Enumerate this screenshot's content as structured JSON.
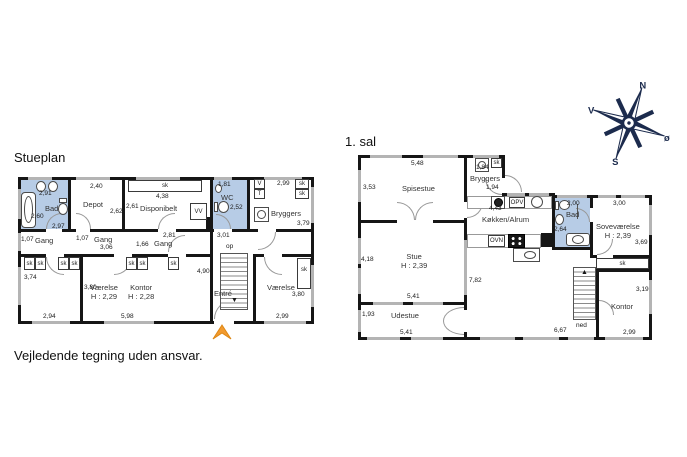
{
  "titles": {
    "stueplan": "Stueplan",
    "first_floor": "1. sal",
    "disclaimer": "Vejledende tegning uden ansvar."
  },
  "labels": {
    "sk": "sk",
    "op": "op",
    "ned": "ned",
    "vv": "VV",
    "v": "V",
    "t": "T",
    "opv": "OPV",
    "ovn": "OVN"
  },
  "compass": {
    "north": "N",
    "south": "S",
    "west": "V",
    "east": "ø"
  },
  "colors": {
    "wall": "#161616",
    "window_gray": "#b4b4b4",
    "wet_room_blue": "#b7cce6",
    "entrance_arrow_orange": "#f29a2e",
    "compass_navy": "#1c2b4d"
  },
  "stueplan": {
    "bad": {
      "name": "Bad",
      "dim_sinks": "2,91",
      "dim_left": "2,60",
      "dim_bottom": "2,97"
    },
    "depot": {
      "name": "Depot",
      "dim_top": "2,40",
      "dim_right": "2,62"
    },
    "disponibelt": {
      "name": "Disponibelt",
      "closet_dim": "4,38",
      "dim_left": "2,61"
    },
    "wc": {
      "name": "WC",
      "dim_top": "1,81",
      "dim_right": "2,52",
      "dim_bottom": "3,01"
    },
    "bryggers": {
      "name": "Bryggers",
      "dim_top": "2,99",
      "dim_right": "3,79"
    },
    "gang_left": {
      "name": "Gang",
      "dim_width": "1,07"
    },
    "gang_mid": {
      "name": "Gang",
      "dim_width": "1,07",
      "dim_length": "3,06"
    },
    "gang_right": {
      "name": "Gang",
      "dim_top": "2,81",
      "dim_width": "1,66"
    },
    "vaerelse_left": {
      "name": "Værelse",
      "height": "H : 2,29",
      "dim_left": "3,74",
      "dim_bottom": "2,94"
    },
    "kontor": {
      "name": "Kontor",
      "height": "H : 2,28",
      "dim_left": "3,80",
      "dim_bottom": "5,98",
      "dim_right": "4,90"
    },
    "entre": {
      "name": "Entré"
    },
    "vaerelse_right": {
      "name": "Værelse",
      "dim_right": "3,80",
      "dim_bottom": "2,99"
    }
  },
  "first_floor": {
    "spisestue": {
      "name": "Spisestue",
      "dim_top": "5,48",
      "dim_left": "3,53"
    },
    "bryggers": {
      "name": "Bryggers",
      "dim_top": "1,84",
      "dim_bottom": "1,94"
    },
    "koekken_alrum": {
      "name": "Køkken/Alrum",
      "dim_top": "4,43"
    },
    "bad": {
      "name": "Bad",
      "dim_top": "2,00",
      "dim_left": "2,64"
    },
    "sovevaerelse": {
      "name": "Soveværelse",
      "height": "H : 2,39",
      "dim_top": "3,00",
      "dim_right": "3,69"
    },
    "kontor": {
      "name": "Kontor",
      "dim_right": "3,19",
      "dim_bottom": "2,99"
    },
    "stue": {
      "name": "Stue",
      "height": "H : 2,39",
      "dim_left": "4,18",
      "dim_bottom": "5,41",
      "dim_right": "7,82"
    },
    "udestue": {
      "name": "Udestue",
      "dim_left": "1,93",
      "dim_bottom": "5,41"
    },
    "open_area": {
      "dim_bottom": "6,67"
    }
  }
}
